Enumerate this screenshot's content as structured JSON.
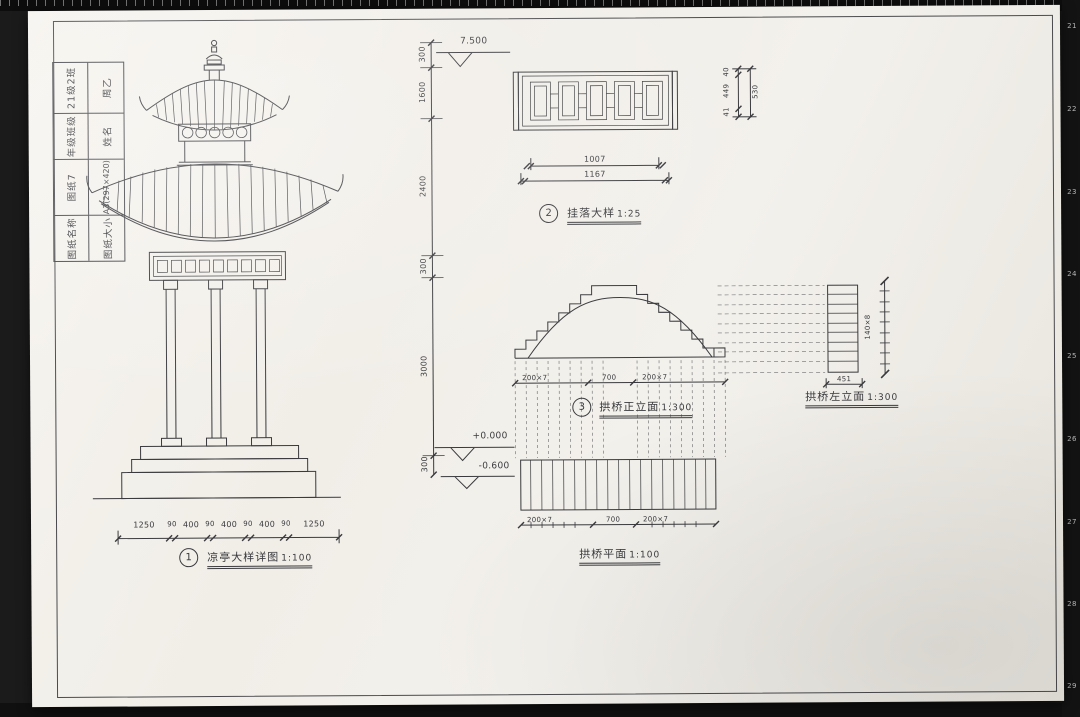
{
  "colors": {
    "background": "#161616",
    "paper": "#f2efe9",
    "ink": "#3a3a3e",
    "frame": "#4a4a4e"
  },
  "title_block": {
    "cells": [
      {
        "label": "图纸名称",
        "value": "图纸7"
      },
      {
        "label": "年级班级",
        "value": "21级2班"
      },
      {
        "label": "图纸大小",
        "value": "A3(297×420)"
      },
      {
        "label": "姓名",
        "value": "周乙"
      }
    ]
  },
  "figures": {
    "pavilion": {
      "callout": "1",
      "label": "凉亭大样详图",
      "scale": "1:100",
      "bottom_dims": [
        "1250",
        "90",
        "400",
        "90",
        "400",
        "90",
        "400",
        "90",
        "1250"
      ],
      "height_dims": [
        "300",
        "1600",
        "2400",
        "300",
        "3000",
        "300"
      ],
      "elevations": {
        "top": "7.500",
        "zero": "+0.000",
        "base": "-0.600"
      }
    },
    "guazhao": {
      "callout": "2",
      "label": "挂落大样",
      "scale": "1:25",
      "width_dims": [
        "1007",
        "1167"
      ],
      "height_dims": [
        "40",
        "449",
        "41"
      ],
      "height_total": "530"
    },
    "bridge_front": {
      "callout": "3",
      "label": "拱桥正立面",
      "scale": "1:300",
      "bottom_dims": [
        "200×7",
        "700",
        "200×7"
      ]
    },
    "bridge_plan": {
      "label": "拱桥平面",
      "scale": "1:100",
      "bottom_dims": [
        "200×7",
        "700",
        "200×7"
      ]
    },
    "bridge_side": {
      "label": "拱桥左立面",
      "scale": "1:300",
      "height_dim": "140×8",
      "width_dim": "451"
    }
  },
  "ruler": {
    "numbers": [
      "21",
      "22",
      "23",
      "24",
      "25",
      "26",
      "27",
      "28",
      "29"
    ]
  }
}
